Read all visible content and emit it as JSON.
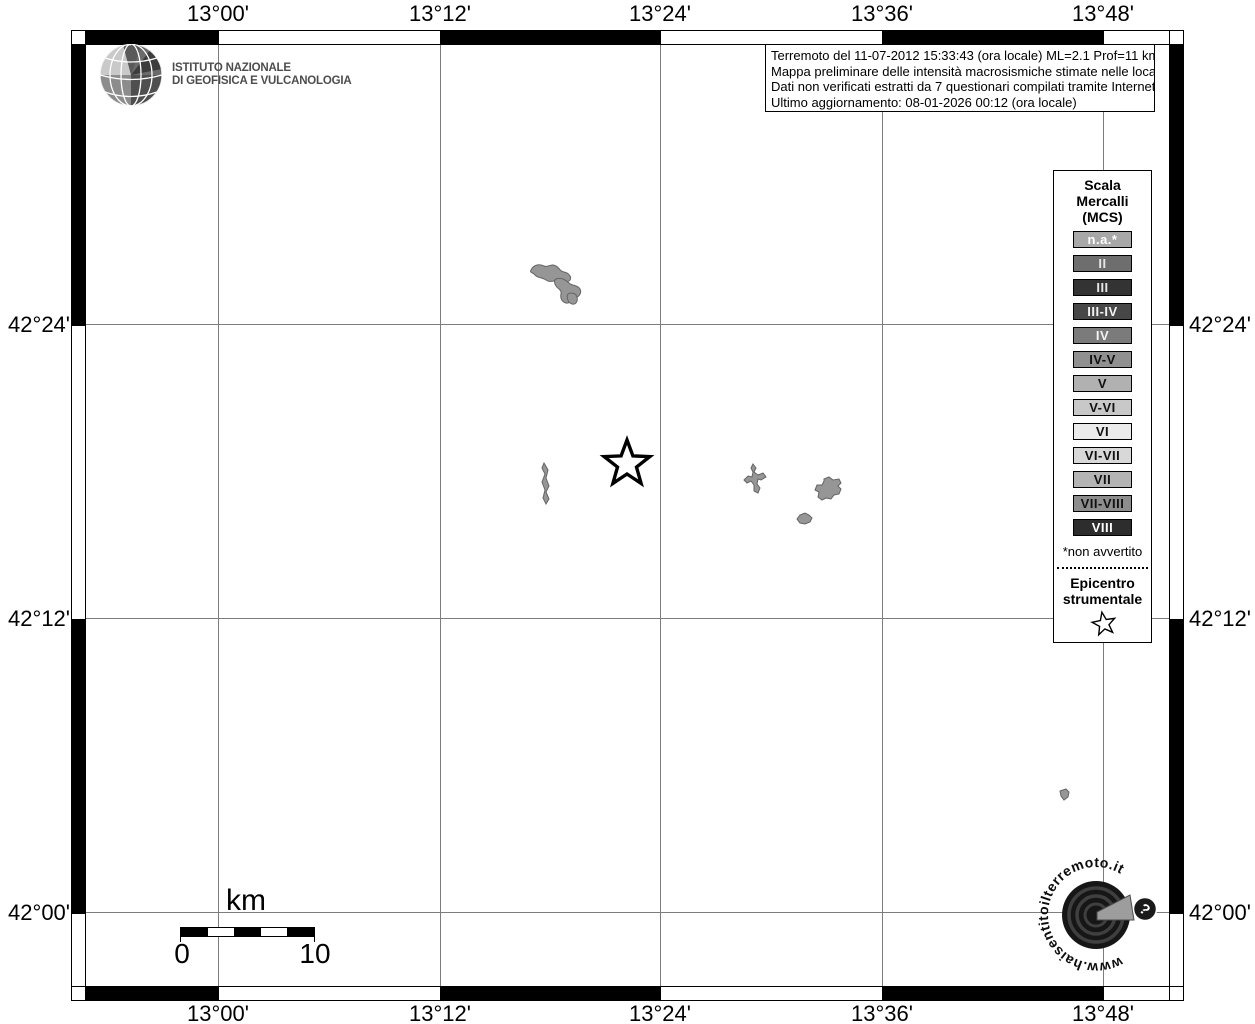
{
  "branding": {
    "institute_line1": "ISTITUTO NAZIONALE",
    "institute_line2": "DI GEOFISICA E VULCANOLOGIA"
  },
  "info_box": {
    "line1": "Terremoto del 11-07-2012 15:33:43 (ora locale) ML=2.1 Prof=11 km",
    "line2": "Mappa preliminare delle intensità macrosismiche stimate nelle località",
    "line3": "Dati non verificati estratti da 7 questionari compilati tramite Internet.",
    "line4": "Ultimo aggiornamento: 08-01-2026 00:12 (ora locale)"
  },
  "legend": {
    "title_lines": [
      "Scala",
      "Mercalli",
      "(MCS)"
    ],
    "items": [
      {
        "label": "n.a.*",
        "color": "#a8a8a8",
        "text_color": "#ffffff"
      },
      {
        "label": "II",
        "color": "#6e6e6e",
        "text_color": "#e6e6e6"
      },
      {
        "label": "III",
        "color": "#333333",
        "text_color": "#e6e6e6"
      },
      {
        "label": "III-IV",
        "color": "#474747",
        "text_color": "#f2f2f2"
      },
      {
        "label": "IV",
        "color": "#7b7b7b",
        "text_color": "#f2f2f2"
      },
      {
        "label": "IV-V",
        "color": "#909090",
        "text_color": "#111111"
      },
      {
        "label": "V",
        "color": "#b1b1b1",
        "text_color": "#111111"
      },
      {
        "label": "V-VI",
        "color": "#c8c8c8",
        "text_color": "#111111"
      },
      {
        "label": "VI",
        "color": "#ebebeb",
        "text_color": "#111111"
      },
      {
        "label": "VI-VII",
        "color": "#d8d8d8",
        "text_color": "#111111"
      },
      {
        "label": "VII",
        "color": "#b4b4b4",
        "text_color": "#111111"
      },
      {
        "label": "VII-VIII",
        "color": "#8d8d8d",
        "text_color": "#111111"
      },
      {
        "label": "VIII",
        "color": "#2d2d2d",
        "text_color": "#ffffff"
      }
    ],
    "footnote": "*non avvertito",
    "epicenter_label_line1": "Epicentro",
    "epicenter_label_line2": "strumentale",
    "epicenter_symbol": "star-outline"
  },
  "axes": {
    "meridians": [
      "13°00'",
      "13°12'",
      "13°24'",
      "13°36'",
      "13°48'"
    ],
    "parallels": [
      "42°24'",
      "42°12'",
      "42°00'"
    ]
  },
  "scale_bar": {
    "unit": "km",
    "start": "0",
    "end": "10"
  },
  "watermark": {
    "url_text": "www.haisentitoilterremoto.it",
    "badge": "?"
  },
  "map": {
    "epicenter_symbol": "star-outline",
    "locality_fill": "#969696"
  }
}
